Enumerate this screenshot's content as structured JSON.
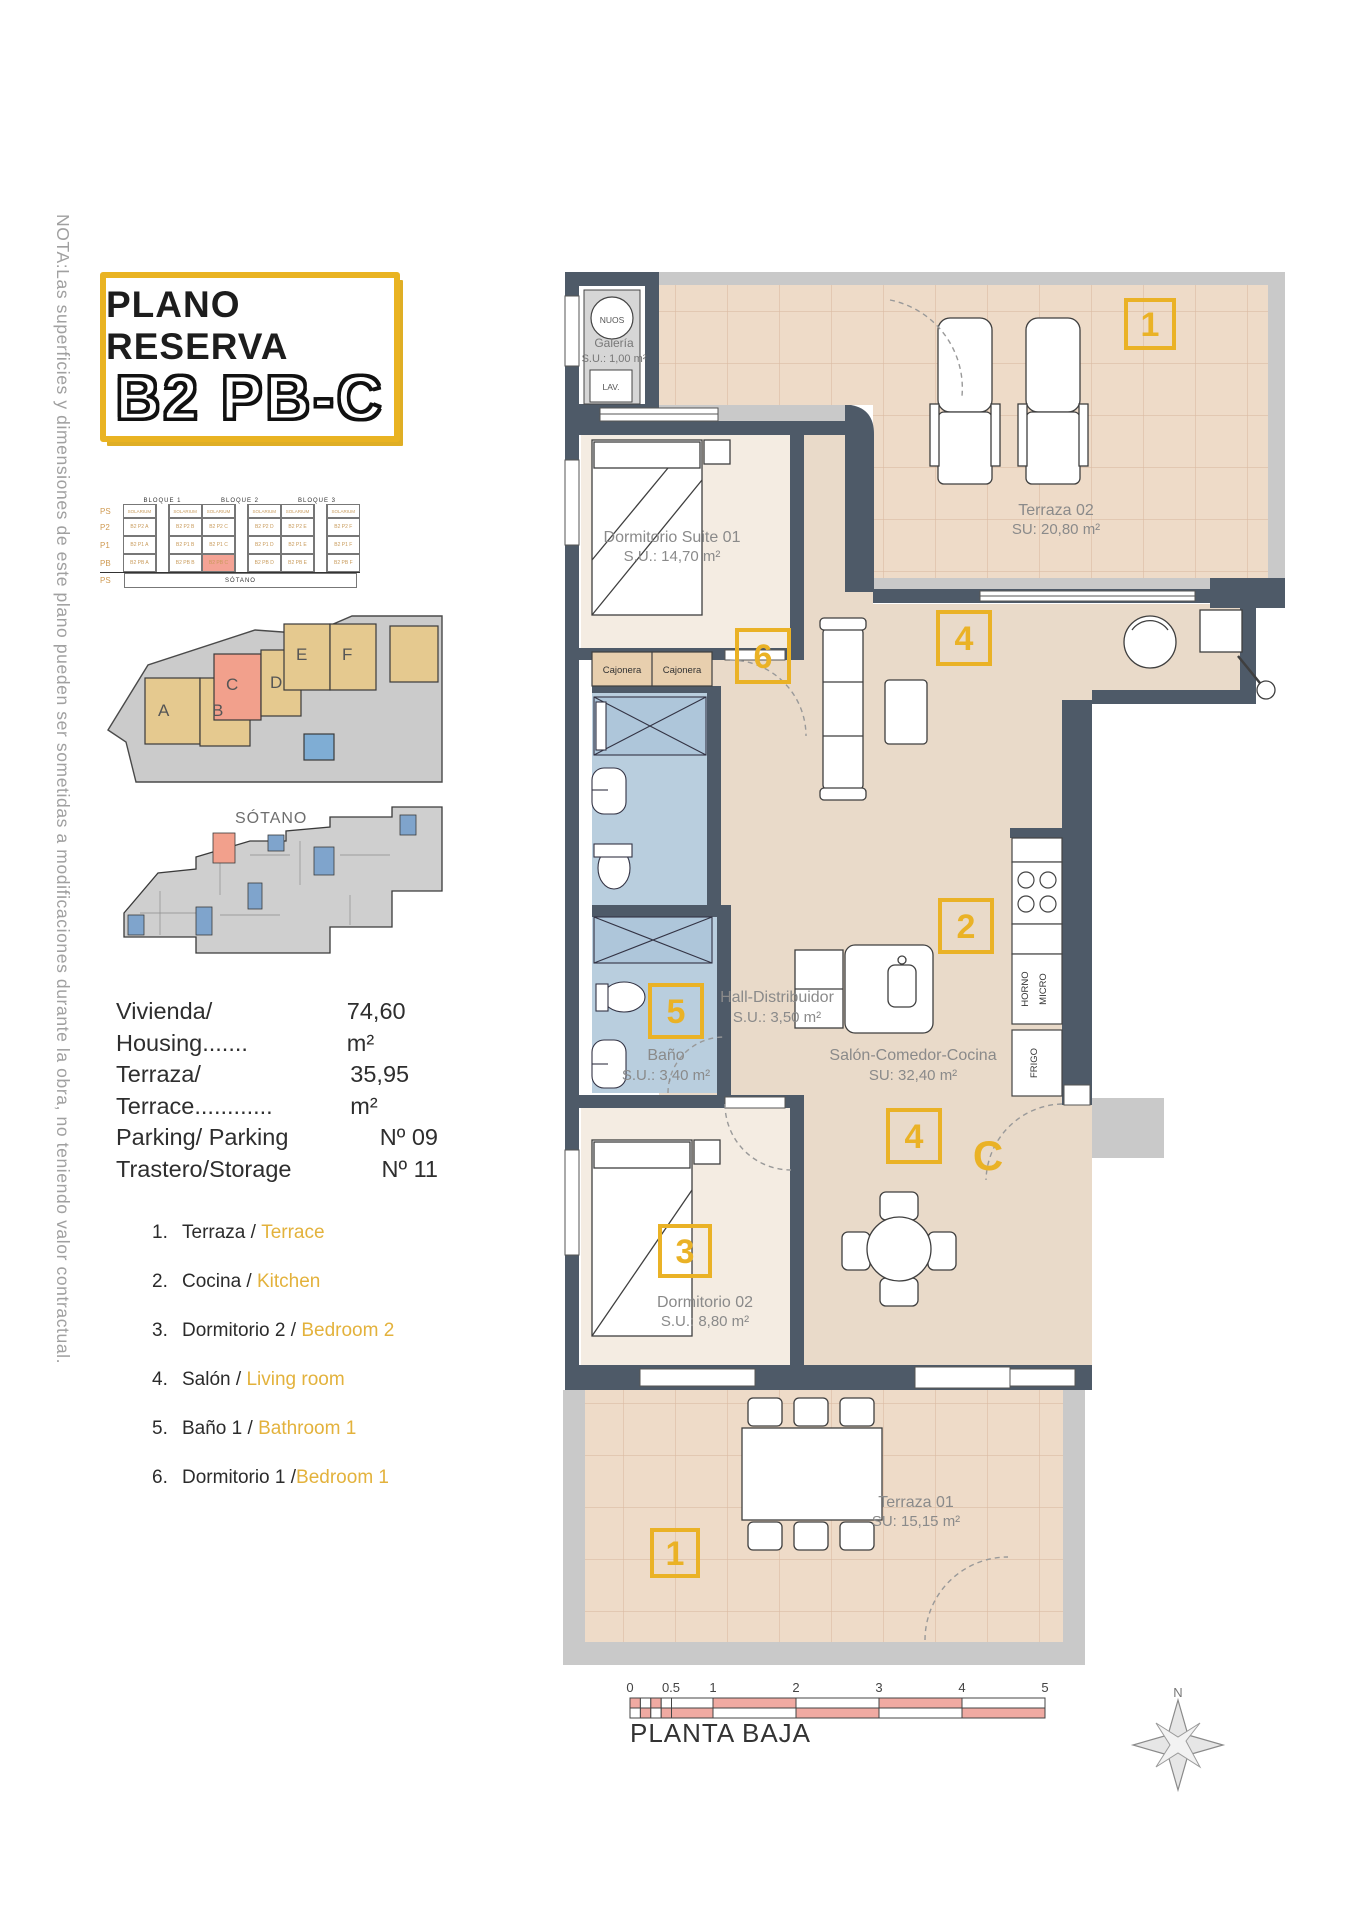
{
  "note_vertical": "NOTA:Las superficies y dimensiones de este plano pueden ser sometidas a modificaciones durante la obra, no teniendo valor contractual.",
  "title": {
    "line1": "PLANO RESERVA",
    "line2": "B2 PB-C"
  },
  "schedule": {
    "blocks": [
      "BLOQUE 1",
      "BLOQUE 2",
      "BLOQUE 3"
    ],
    "rows": [
      {
        "label": "PS",
        "cells": [
          "SOLARIUM",
          "SOLARIUM",
          "SOLARIUM",
          "SOLARIUM",
          "SOLARIUM",
          "SOLARIUM"
        ]
      },
      {
        "label": "P2",
        "cells": [
          "B2 P2 A",
          "B2 P2 B",
          "B2 P2 C",
          "B2 P2 D",
          "B2 P2 E",
          "B2 P2 F"
        ]
      },
      {
        "label": "P1",
        "cells": [
          "B2 P1 A",
          "B2 P1 B",
          "B2 P1 C",
          "B2 P1 D",
          "B2 P1 E",
          "B2 P1 F"
        ]
      },
      {
        "label": "PB",
        "cells": [
          "B2 PB A",
          "B2 PB B",
          "B2 PB C",
          "B2 PB D",
          "B2 PB E",
          "B2 PB F"
        ]
      },
      {
        "label": "PS",
        "cells": [
          "SÓTANO"
        ]
      }
    ],
    "highlighted_unit": "B2 PB C"
  },
  "site": {
    "buildings": [
      "A",
      "B",
      "C",
      "D",
      "E",
      "F"
    ],
    "highlighted": "C",
    "sotano_label": "SÓTANO"
  },
  "info": {
    "rows": [
      {
        "label": "Vivienda/ Housing.......",
        "value": "74,60 m²"
      },
      {
        "label": "Terraza/ Terrace............",
        "value": "35,95 m²"
      },
      {
        "label": "Parking/ Parking",
        "value": "Nº 09"
      },
      {
        "label": "Trastero/Storage",
        "value": "Nº 11"
      }
    ]
  },
  "legend": {
    "items": [
      {
        "num": "1.",
        "es": "Terraza",
        "sep": " / ",
        "en": "Terrace"
      },
      {
        "num": "2.",
        "es": "Cocina",
        "sep": " / ",
        "en": "Kitchen"
      },
      {
        "num": "3.",
        "es": "Dormitorio 2",
        "sep": " / ",
        "en": "Bedroom 2"
      },
      {
        "num": "4.",
        "es": "Salón",
        "sep": " / ",
        "en": "Living room"
      },
      {
        "num": "5.",
        "es": "Baño 1",
        "sep": " / ",
        "en": "Bathroom 1"
      },
      {
        "num": "6.",
        "es": "Dormitorio 1",
        "sep": " /",
        "en": "Bedroom 1"
      }
    ]
  },
  "plan": {
    "galeria_appliance": "NUOS",
    "galeria_name": "Galería",
    "galeria_area": "S.U.: 1,00 m²",
    "galeria_lav": "LAV.",
    "suite_name": "Dormitorio Suite 01",
    "suite_area": "S.U.: 14,70 m²",
    "terraza02_name": "Terraza 02",
    "terraza02_area": "SU: 20,80 m²",
    "cajonera1": "Cajonera",
    "cajonera2": "Cajonera",
    "hall_name": "Hall-Distribuidor",
    "hall_area": "S.U.: 3,50 m²",
    "salon_name": "Salón-Comedor-Cocina",
    "salon_area": "SU: 32,40 m²",
    "bano_name": "Baño",
    "bano_area": "S.U.: 3,40 m²",
    "dorm02_name": "Dormitorio 02",
    "dorm02_area": "S.U.: 8,80 m²",
    "terraza01_name": "Terraza 01",
    "terraza01_area": "SU: 15,15 m²",
    "horno": "HORNO",
    "micro": "MICRO",
    "frigo": "FRIGO",
    "badge_terraza02": "1",
    "badge_suite": "6",
    "badge_salon": "4",
    "badge_cocina": "2",
    "badge_bano": "5",
    "badge_salon2": "4",
    "badge_dorm02": "3",
    "badge_terraza01": "1",
    "door_letter": "C"
  },
  "scalebar": {
    "ticks": [
      "0",
      "0.5",
      "1",
      "2",
      "3",
      "4",
      "5"
    ]
  },
  "plan_title": "PLANTA BAJA",
  "compass": {
    "label": "N"
  },
  "colors": {
    "accent_yellow": "#e9b322",
    "highlight_salmon": "#f2a08c",
    "wall_dark": "#4e5a68",
    "bath_blue": "#b9cede",
    "pool_blue": "#7fadd4",
    "scale_pink": "#f0aaa2",
    "legend_gold": "#e3b23c"
  }
}
